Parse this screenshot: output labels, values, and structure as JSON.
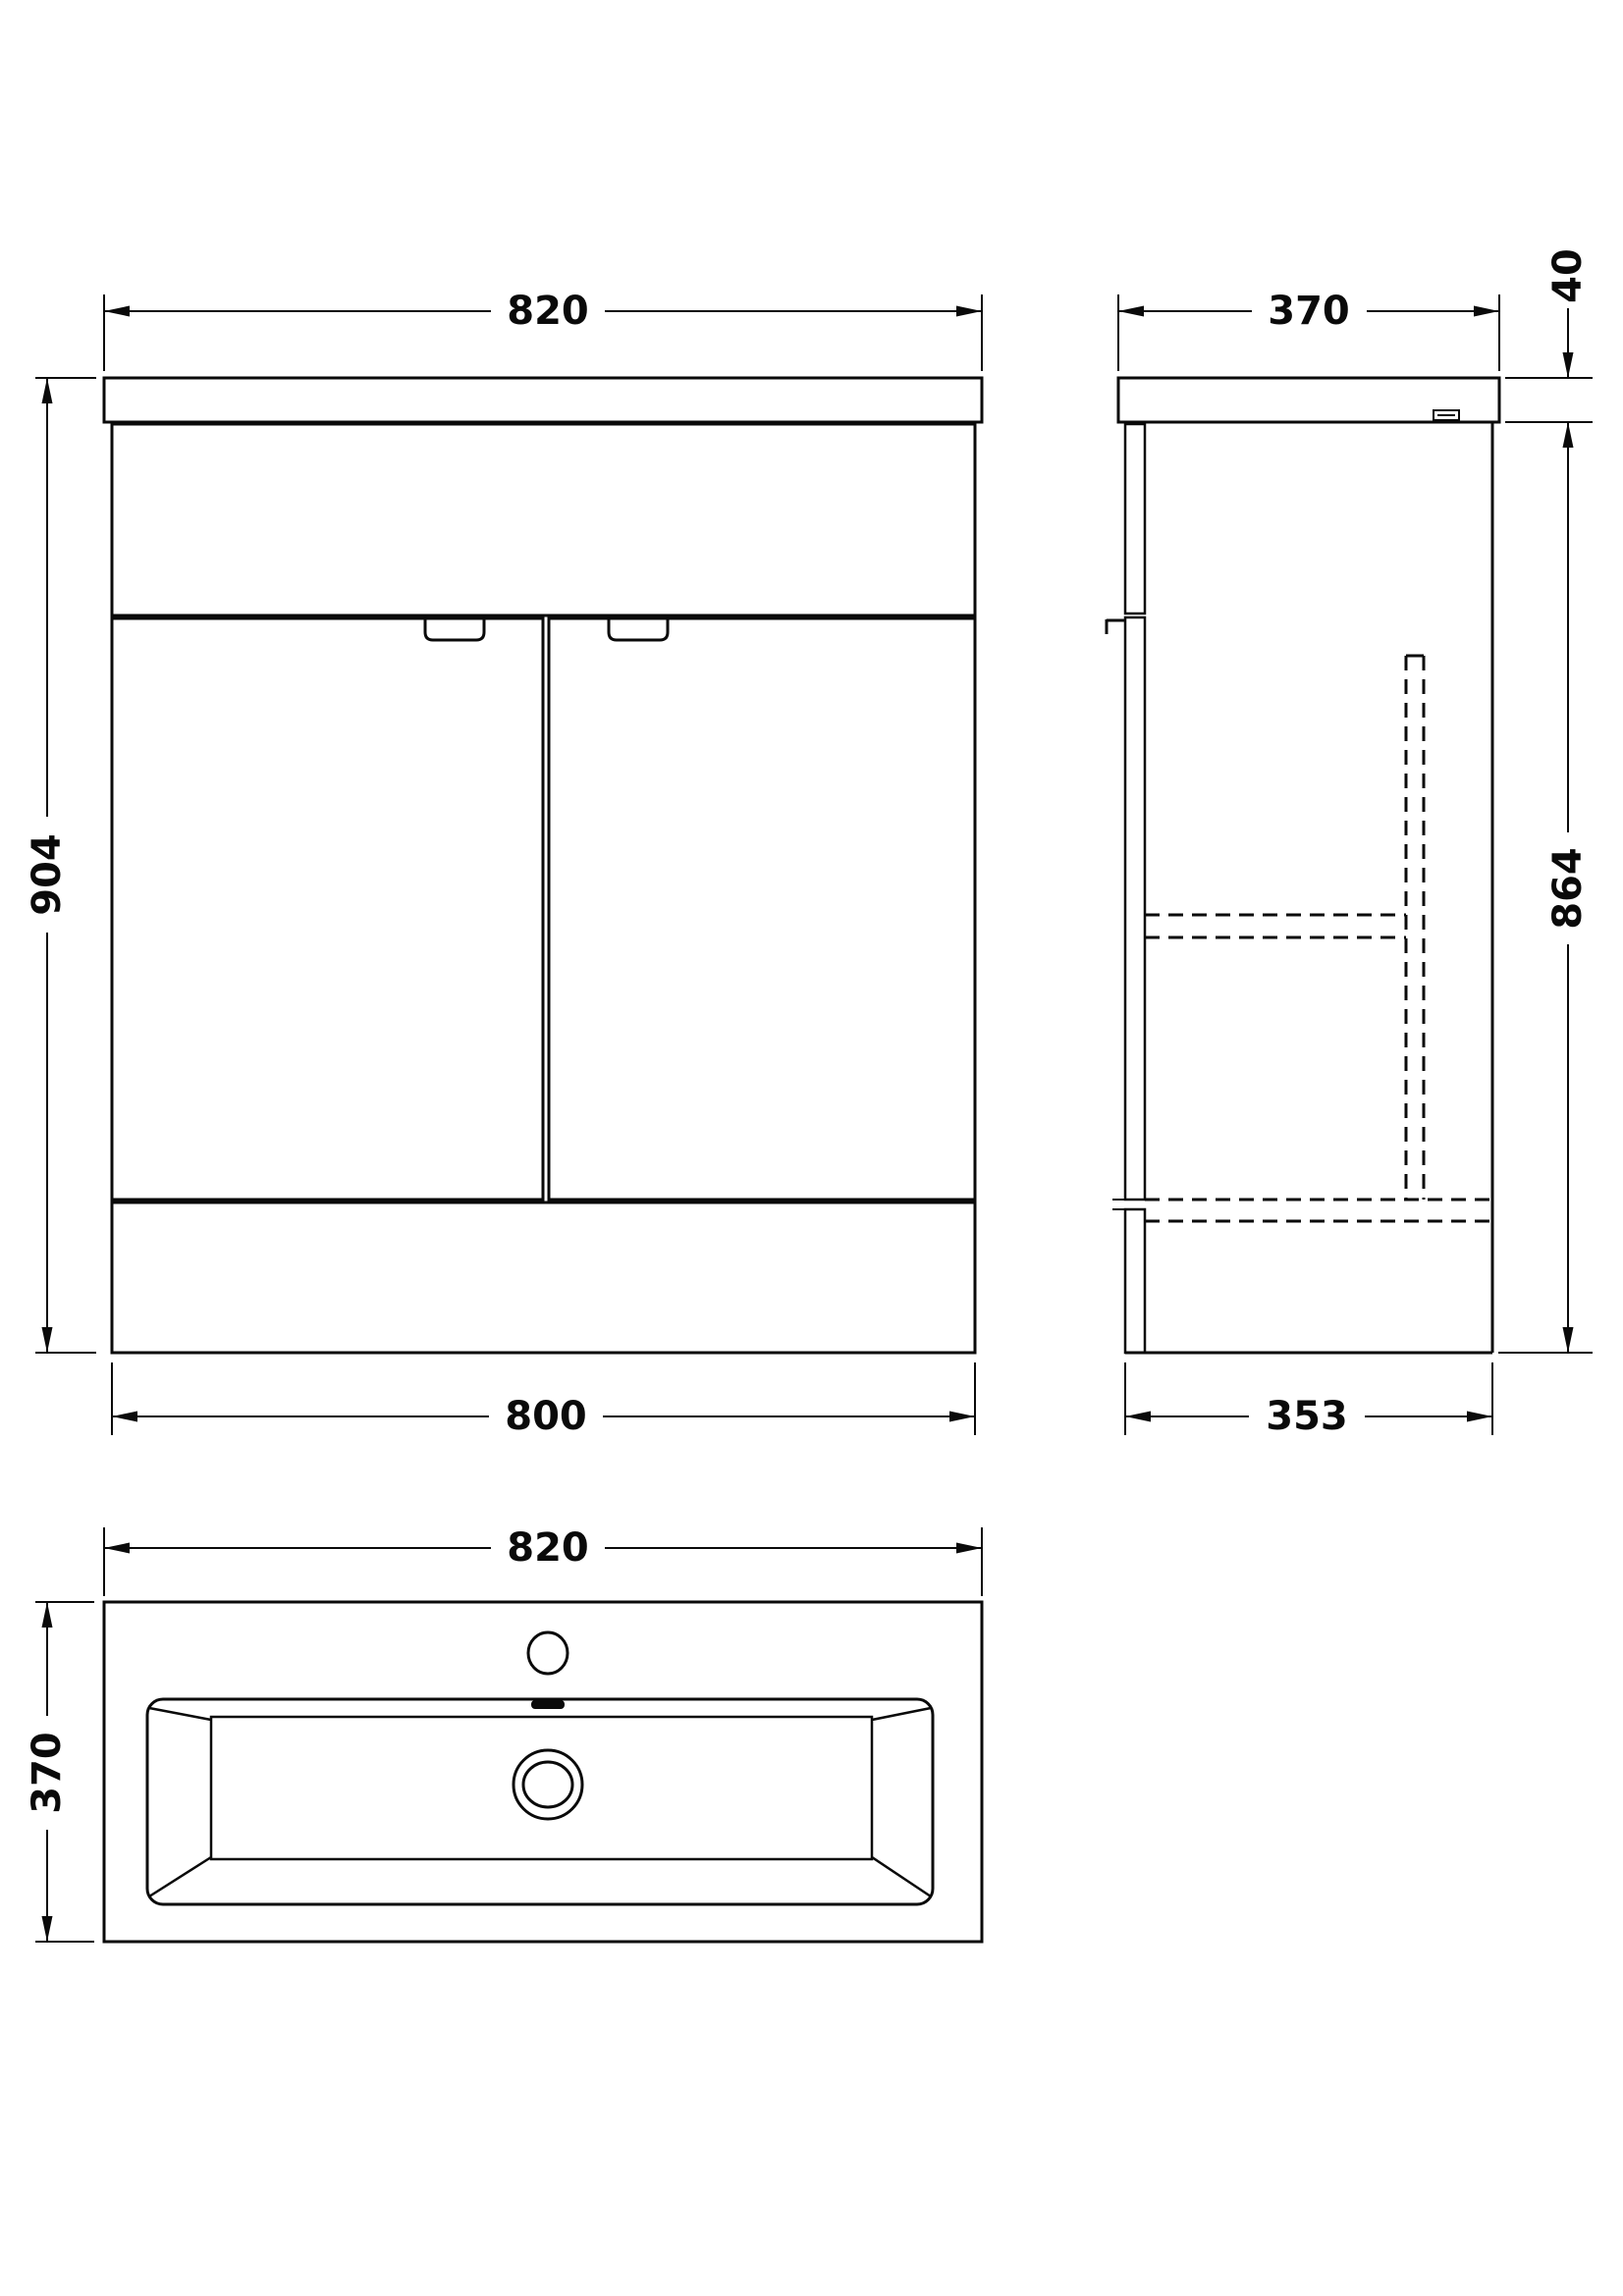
{
  "diagram": {
    "front_view": {
      "width_top": "820",
      "height": "904",
      "width_bottom": "800"
    },
    "side_view": {
      "depth_top": "370",
      "worktop_thickness": "40",
      "cabinet_height": "864",
      "depth_bottom": "353"
    },
    "plan_view": {
      "width": "820",
      "depth": "370"
    }
  }
}
